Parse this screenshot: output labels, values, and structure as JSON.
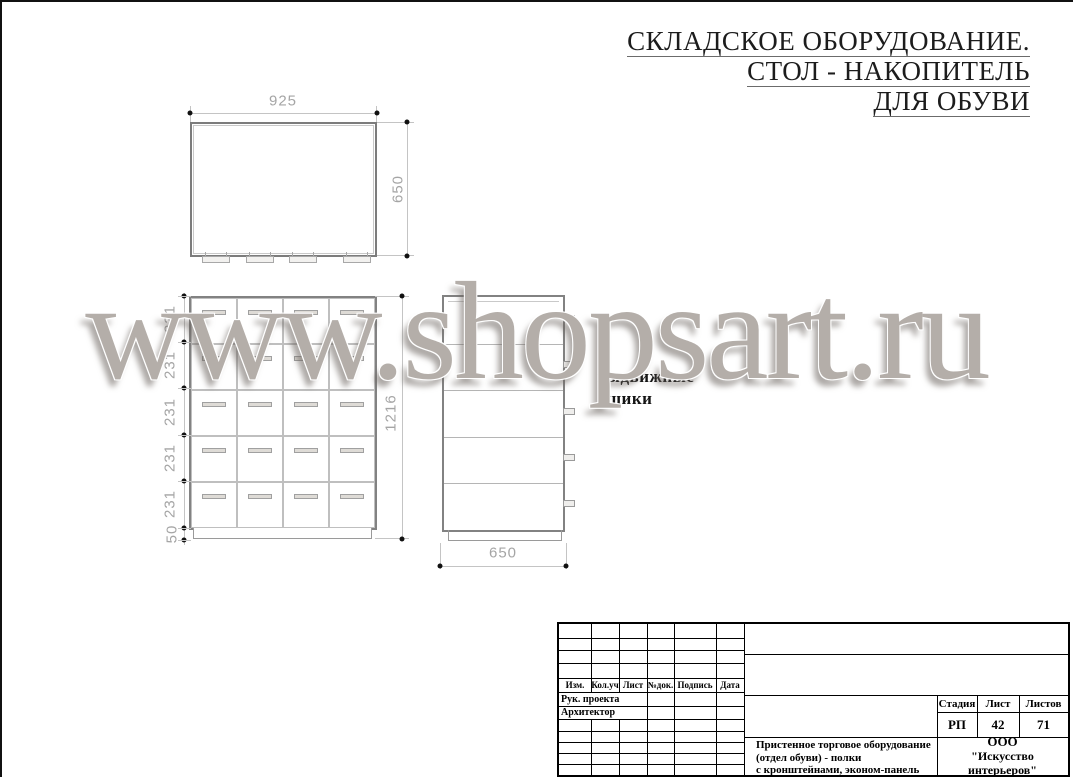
{
  "header": {
    "line1": "СКЛАДСКОЕ ОБОРУДОВАНИЕ.",
    "line2": "СТОЛ - НАКОПИТЕЛЬ",
    "line3": "ДЛЯ ОБУВИ"
  },
  "watermark": {
    "text": "www.shopsart.ru",
    "color": "#b4aea9"
  },
  "drawing": {
    "top_view": {
      "dim_width": "925",
      "dim_depth": "650"
    },
    "front_view": {
      "rows": 5,
      "cols": 4,
      "row_dims": [
        "231",
        "231",
        "231",
        "231",
        "231"
      ],
      "base_dim": "50",
      "total_height_dim": "1216"
    },
    "side_view": {
      "rows": 5,
      "dim_width": "650"
    },
    "annotation_line1": "выдвижные",
    "annotation_line2": "ящики"
  },
  "title_block": {
    "col_headers": [
      "Изм.",
      "Кол.уч",
      "Лист",
      "№док.",
      "Подпись",
      "Дата"
    ],
    "role_row1": "Рук. проекта",
    "role_row2": "Архитектор",
    "stage_header1": "Стадия",
    "stage_header2": "Лист",
    "stage_header3": "Листов",
    "stage_value": "РП",
    "sheet_no": "42",
    "sheets_total": "71",
    "description_line1": "Пристенное торговое оборудование",
    "description_line2": "(отдел обуви) - полки",
    "description_line3": "с кронштейнами, эконом-панель",
    "company_line1": "ООО",
    "company_line2": "\"Искусство интерьеров\""
  }
}
